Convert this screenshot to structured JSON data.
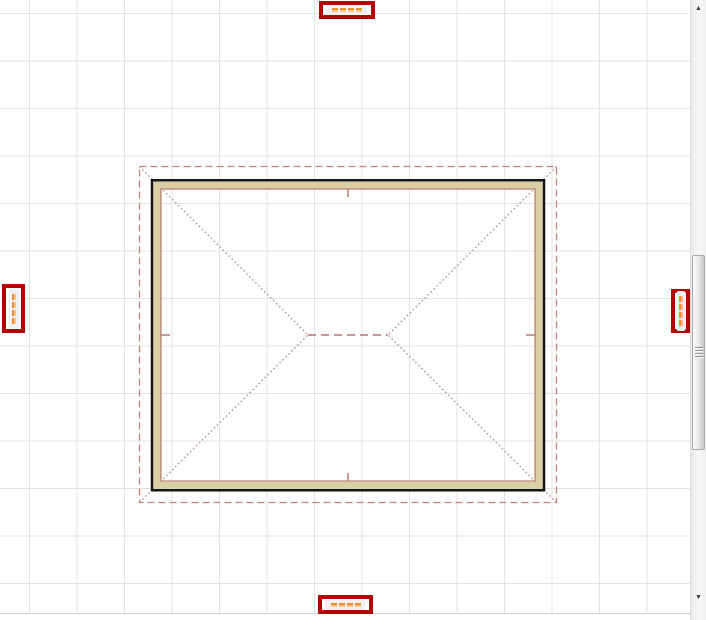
{
  "app": {
    "view_description": "2D plan-view CAD viewport showing a hip roof over rectangular exterior walls on a grid"
  },
  "colors": {
    "canvas_bg": "#ffffff",
    "grid_line": "#e3e3e3",
    "wall_outline": "#151515",
    "wall_fill": "#d9cfa2",
    "wall_inner_line": "#a8645c",
    "roof_overhang_line": "#c4807c",
    "roof_hip_line": "#bd8a86",
    "roof_ridge_line": "#b5736f",
    "annotation_border": "#b40404",
    "annotation_pill_bg": "#f1f1f1",
    "redacted_text_highlight": "#ef8c2e"
  },
  "drawing": {
    "type": "hip-roof-plan",
    "elements": [
      "roof-overhang-dashed-outline",
      "exterior-wall-rectangle",
      "hip-lines-to-ridge",
      "ridge-line",
      "wall-center-tick-marks"
    ]
  },
  "annotations": {
    "note": "Four red boxes highlight tiny illegible dimension labels rendered as orange segments",
    "labels": [
      {
        "id": "dimension-top",
        "side": "top",
        "orientation": "horizontal",
        "segments": 4
      },
      {
        "id": "dimension-bottom",
        "side": "bottom",
        "orientation": "horizontal",
        "segments": 4
      },
      {
        "id": "dimension-left",
        "side": "left",
        "orientation": "vertical",
        "segments": 4
      },
      {
        "id": "dimension-right",
        "side": "right",
        "orientation": "vertical",
        "segments": 4
      }
    ]
  },
  "scrollbar": {
    "up_glyph": "▲",
    "down_glyph": "▼"
  }
}
